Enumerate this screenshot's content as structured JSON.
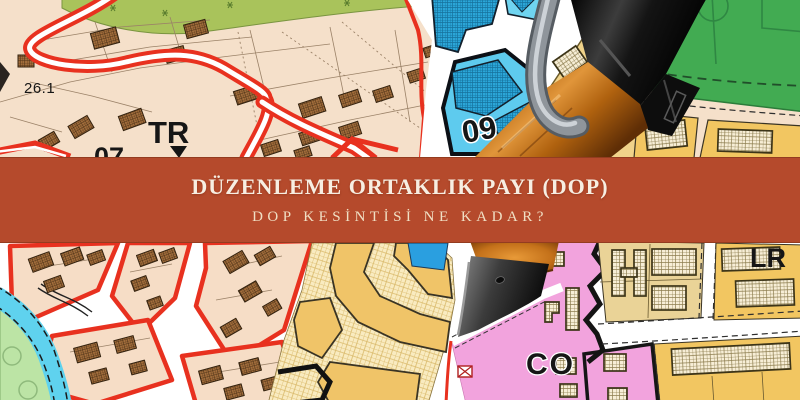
{
  "banner": {
    "title": "DÜZENLEME ORTAKLIK PAYI (DOP)",
    "subtitle": "DOP KESİNTİSİ NE KADAR?",
    "background_color": "#b54a2c",
    "title_color": "#f7eee2",
    "subtitle_color": "#f0dfc4"
  },
  "map": {
    "labels": {
      "parcel_26_1": "26.1",
      "zone_tr": "TR",
      "zone_07": "07",
      "zone_09": "09",
      "parcel_25_3": "25.3",
      "zone_co": "CO",
      "zone_lr": "LR"
    },
    "colors": {
      "residential_beige": "#f5e0ca",
      "building_brown": "#a36e3c",
      "road_red": "#e8311f",
      "commercial_blue": "#2ba6d8",
      "commercial_blue_light": "#6fd4f0",
      "park_green": "#42ab52",
      "greenbelt_olive": "#a9c35b",
      "zone_yellow": "#f2c661",
      "zone_yellow_hatch": "#f9ebc0",
      "zone_tan": "#ead397",
      "zone_pink": "#f2a3dd",
      "water_cyan": "#5fd2ee",
      "shore_green": "#bce4a5",
      "road_white": "#ffffff"
    }
  },
  "pen": {
    "name": "ballpoint-pen",
    "cap_color": "#161616",
    "body_color": "#c9771c",
    "clip_color": "#9aa0a6"
  }
}
